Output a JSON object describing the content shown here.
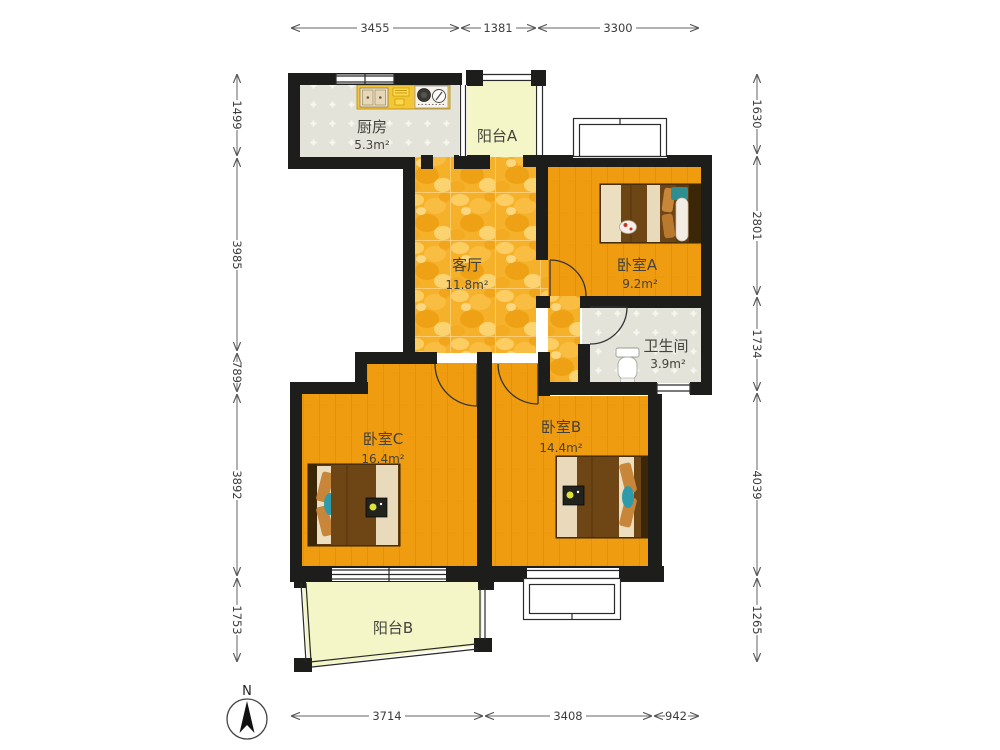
{
  "compass": {
    "label": "N"
  },
  "rooms": {
    "kitchen": {
      "name": "厨房",
      "area": "5.3m²"
    },
    "balcony_a": {
      "name": "阳台A"
    },
    "living": {
      "name": "客厅",
      "area": "11.8m²"
    },
    "bedroom_a": {
      "name": "卧室A",
      "area": "9.2m²"
    },
    "bathroom": {
      "name": "卫生间",
      "area": "3.9m²"
    },
    "bedroom_c": {
      "name": "卧室C",
      "area": "16.4m²"
    },
    "bedroom_b": {
      "name": "卧室B",
      "area": "14.4m²"
    },
    "balcony_b": {
      "name": "阳台B"
    }
  },
  "dimensions": {
    "top": [
      {
        "value": "3455"
      },
      {
        "value": "1381"
      },
      {
        "value": "3300"
      }
    ],
    "bottom": [
      {
        "value": "3714"
      },
      {
        "value": "3408"
      },
      {
        "value": "942"
      }
    ],
    "left": [
      {
        "value": "1499"
      },
      {
        "value": "3985"
      },
      {
        "value": "789"
      },
      {
        "value": "3892"
      },
      {
        "value": "1753"
      }
    ],
    "right": [
      {
        "value": "1630"
      },
      {
        "value": "2801"
      },
      {
        "value": "1734"
      },
      {
        "value": "4039"
      },
      {
        "value": "1265"
      }
    ]
  },
  "colors": {
    "wall": "#1d1d1b",
    "living_floor": "#f6b12b",
    "bedroom_floor": "#f09c10",
    "balcony_floor": "#f4f6c8",
    "tile_floor": "#e4e3da",
    "counter": "#f2c636",
    "accent_teal": "#2f9aa8"
  }
}
